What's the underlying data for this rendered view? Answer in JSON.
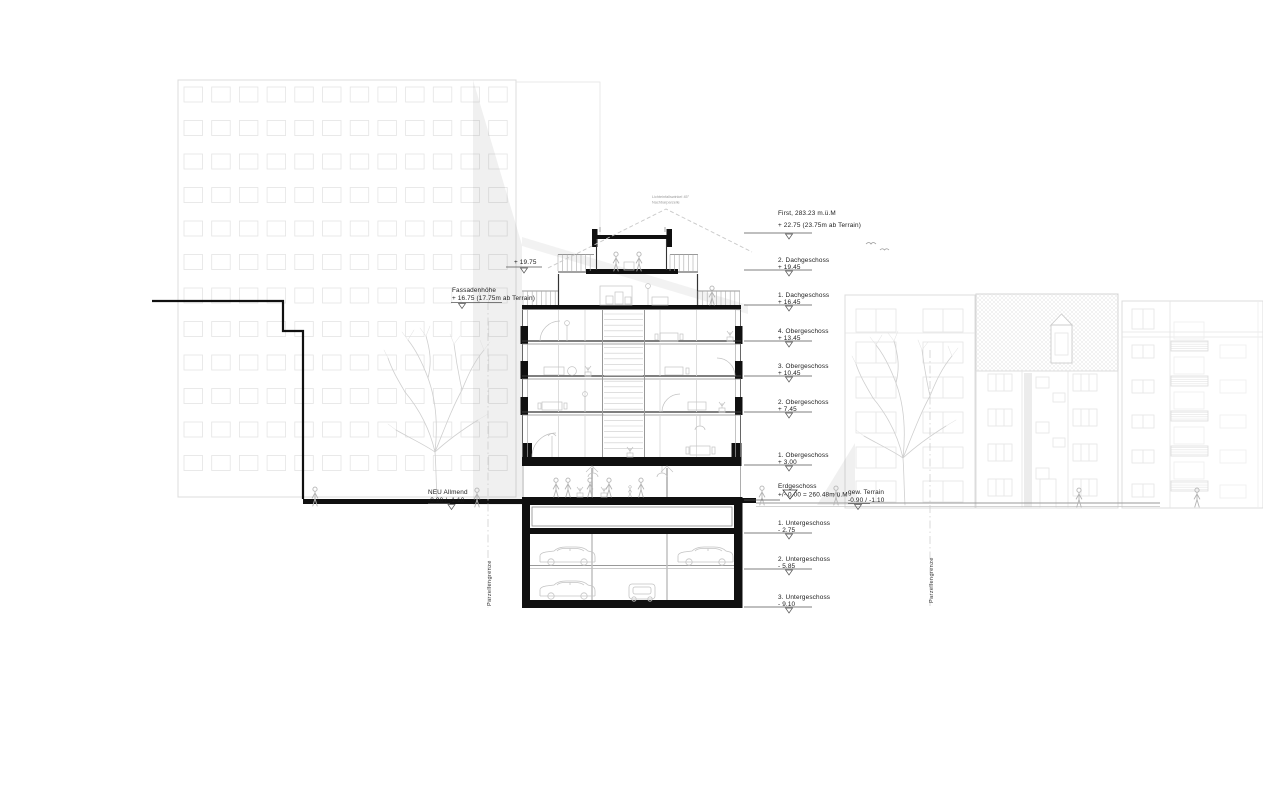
{
  "labels": {
    "right_levels": [
      {
        "name": "First, 283.23 m.ü.M",
        "value": "+ 22.75 (23.75m ab Terrain)"
      },
      {
        "name": "2. Dachgeschoss",
        "value": "+ 19.45"
      },
      {
        "name": "1. Dachgeschoss",
        "value": "+ 16.45"
      },
      {
        "name": "4. Obergeschoss",
        "value": "+ 13.45"
      },
      {
        "name": "3. Obergeschoss",
        "value": "+ 10.45"
      },
      {
        "name": "2. Obergeschoss",
        "value": "+ 7.45"
      },
      {
        "name": "1. Obergeschoss",
        "value": "+ 3.00"
      },
      {
        "name": "Erdgeschoss",
        "value": "+/- 0.00 = 260.48m ü.M"
      },
      {
        "name": "1. Untergeschoss",
        "value": "- 2.75"
      },
      {
        "name": "2. Untergeschoss",
        "value": "- 5.85"
      },
      {
        "name": "3. Untergeschoss",
        "value": "- 9.10"
      }
    ],
    "left": {
      "parapet_value": "+ 19.75",
      "fassade_name": "Fassadenhöhe",
      "fassade_value": "+ 16.75 (17.75m ab Terrain)",
      "allmend_name": "NEU Allmend",
      "allmend_value": "-0.90 / -1.10"
    },
    "terrain_name": "gew. Terrain",
    "terrain_value": "-0.90 / -1.10",
    "boundary_left": "Parzellengrenze",
    "boundary_right": "Parzellengrenze",
    "roof_note_line1": "Lichteinfallswinkel 45°",
    "roof_note_line2": "Nachbarparzelle"
  },
  "colors": {
    "paper": "#ffffff",
    "section_ink": "#101010",
    "background_ink": "#dcdcdc",
    "shadow": "rgba(0,0,0,0.06)"
  }
}
